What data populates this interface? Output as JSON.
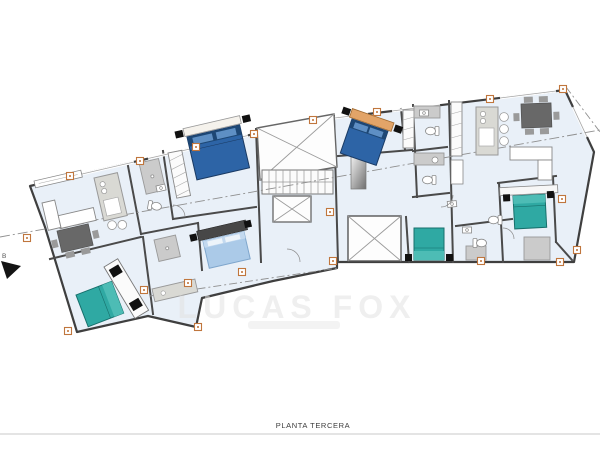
{
  "footer": {
    "label": "PLANTA TERCERA"
  },
  "watermark": {
    "brand": "LUCAS FOX"
  },
  "compass": {
    "label": "B"
  },
  "colors": {
    "floor": "#e9f0f8",
    "wall": "#3f3f3f",
    "bed_dark_blue": "#2d64a6",
    "bed_dark_blue_shade": "#1d4775",
    "bed_light_blue": "#abcae8",
    "bed_teal": "#2fa9a3",
    "bed_teal_light": "#4dbcb5",
    "marker_orange": "#c0763d",
    "cabinet_gray": "#d9d9d4",
    "table_dark": "#686868",
    "headboard_tan": "#e2a468",
    "watermark_gray": "#e2e2e2",
    "footer_text": "#3c3c3c"
  }
}
